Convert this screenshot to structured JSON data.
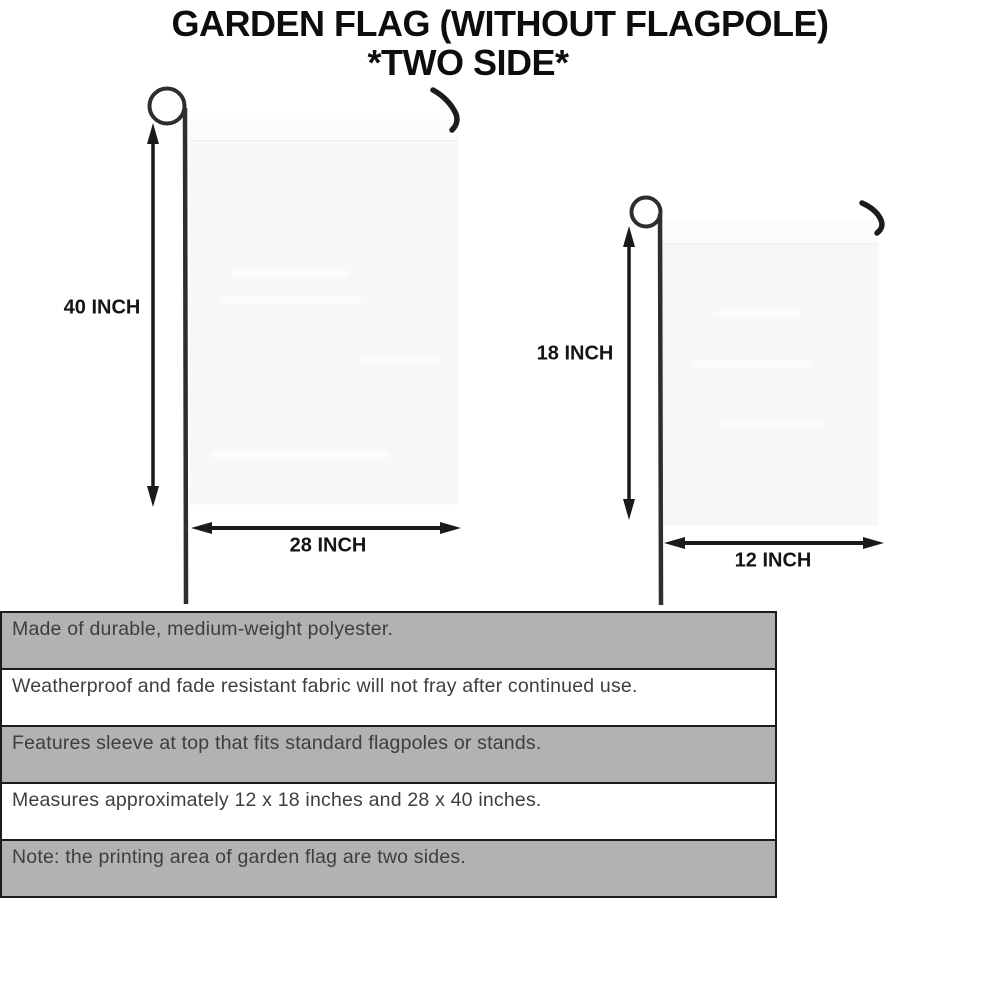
{
  "title": {
    "line1": "GARDEN FLAG (WITHOUT FLAGPOLE)",
    "line2": "*TWO SIDE*"
  },
  "diagrams": {
    "large_flag": {
      "height_label": "40 INCH",
      "width_label": "28 INCH"
    },
    "small_flag": {
      "height_label": "18 INCH",
      "width_label": "12 INCH"
    }
  },
  "features": {
    "rows": [
      "Made of durable, medium-weight polyester.",
      "Weatherproof and fade resistant fabric will not fray after continued use.",
      "Features sleeve at top that fits standard flagpoles or stands.",
      "Measures approximately 12 x 18 inches and 28 x 40 inches.",
      "Note: the printing area of garden flag are two sides."
    ]
  },
  "colors": {
    "row_shaded": "#b2b2b2",
    "row_plain": "#ffffff",
    "table_border": "#1c1c1c",
    "flag_fill": "#f7f7f8",
    "pole_color": "#2e2e2e",
    "hook_color": "#1c1c1c",
    "arrow_color": "#1a1a1a",
    "title_color": "#0d0d0d",
    "feature_text_color": "#3e3e3e"
  }
}
